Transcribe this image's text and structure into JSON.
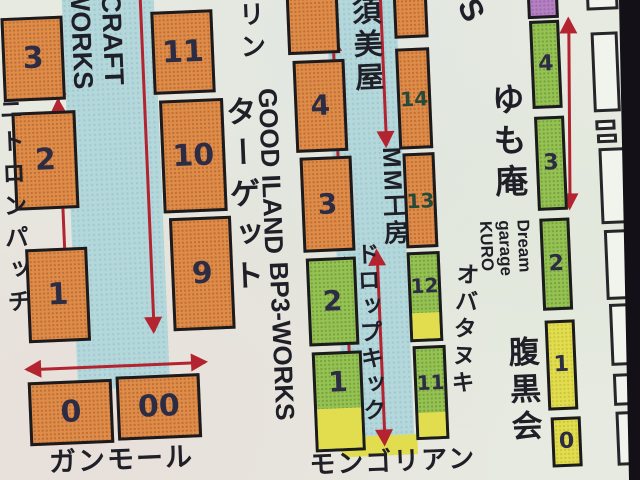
{
  "colors": {
    "paper": "#e7eae1",
    "aisle": "#b4d7db",
    "booth_orange": "#dd8c4a",
    "booth_green": "#96c253",
    "booth_yellow": "#e2dd4e",
    "booth_purple": "#b481c2",
    "arrow_red": "#b32430",
    "ink": "#1f1f28",
    "ink_num": "#2c2c45",
    "ink_num_green": "#27493a",
    "photo_edge": "#141018"
  },
  "labels": {
    "nitron_patch": "ニトロンパッチ",
    "craft_works": "-CRAFT\nWORKS",
    "target": "ターゲット",
    "gun_mall": "ガンモール",
    "rin": "リン",
    "good_iland": "GOOD ILAND",
    "bp3_works": "BP3-WORKS",
    "sumiya": "須美屋",
    "mm_kobo": "MM工房",
    "drop_kick": "ドロップキック",
    "obatanuki": "オバタヌキ",
    "mongolian": "モンゴリアン",
    "yumoan": "ゆも庵",
    "dream_garage": "Dream\ngarage\nKURO",
    "haragurokai": "腹黒会",
    "edge_letter": "S"
  },
  "booths": {
    "col_a": [
      "3",
      "2",
      "1"
    ],
    "col_b": [
      "11",
      "10",
      "9"
    ],
    "col_c": [
      "4",
      "3",
      "2",
      "1"
    ],
    "col_d": [
      "14",
      "13",
      "12",
      "11"
    ],
    "col_e": [
      "4",
      "3",
      "2",
      "1",
      "0"
    ],
    "gun_mall_row": [
      "0",
      "00"
    ]
  }
}
